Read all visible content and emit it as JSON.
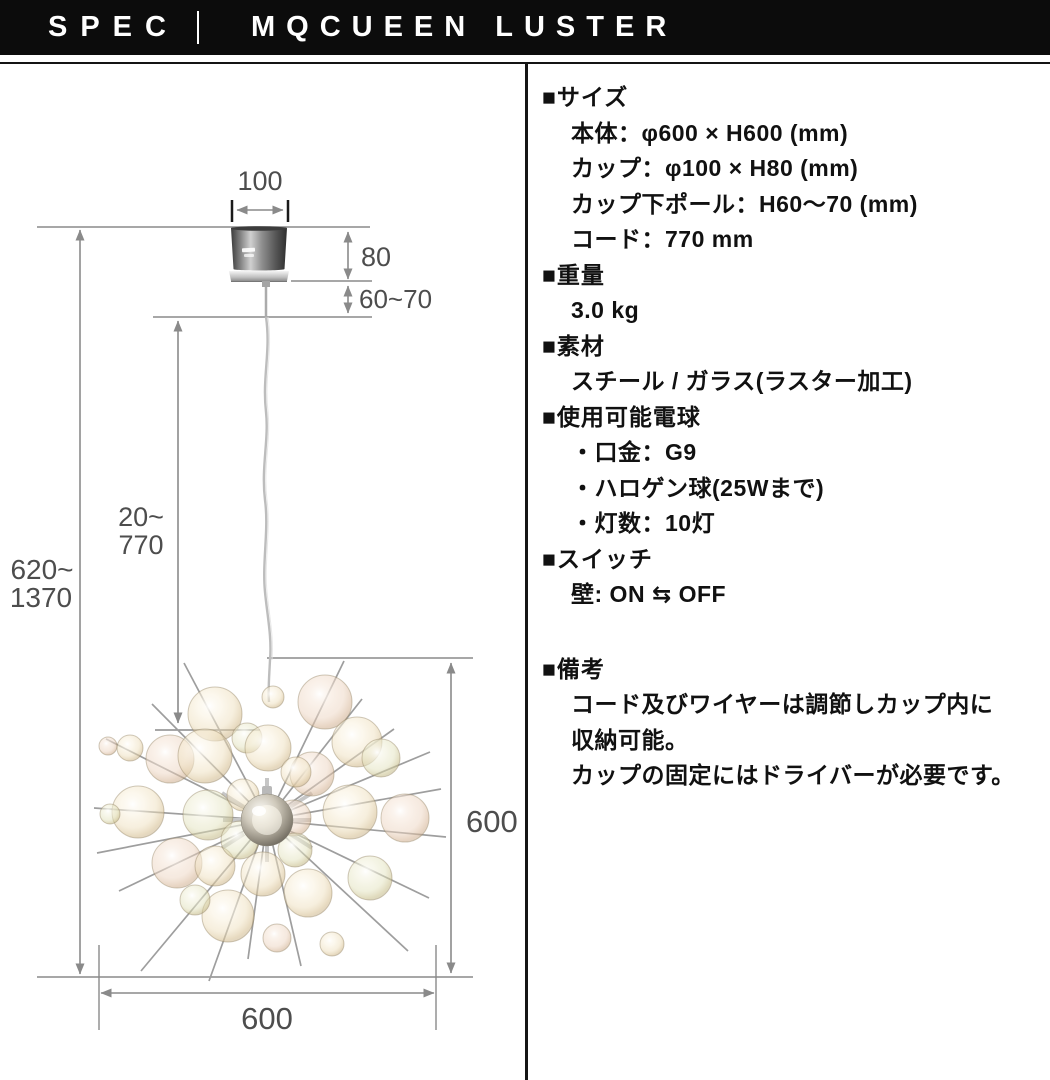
{
  "header": {
    "spec": "SPEC",
    "product": "MQCUEEN LUSTER"
  },
  "colors": {
    "header_bg": "#0c0c0c",
    "divider": "#151515",
    "diagram_line": "#8a8a8a",
    "text": "#111111",
    "glass_tint": "#ecdfc2"
  },
  "diagram": {
    "labels": {
      "canopy_width": "100",
      "canopy_height": "80",
      "pole_length": "60~70",
      "cord_range_top": "20~",
      "cord_range_bottom": "770",
      "overall_range_top": "620~",
      "overall_range_bottom": "1370",
      "body_height": "600",
      "body_width": "600"
    }
  },
  "spec": {
    "sections": [
      {
        "title": "■サイズ",
        "lines": [
          "本体：φ600 × H600 (mm)",
          "カップ：φ100 × H80 (mm)",
          "カップ下ポール：H60～70 (mm)",
          "コード：770 mm"
        ]
      },
      {
        "title": "■重量",
        "lines": [
          "3.0 kg"
        ]
      },
      {
        "title": "■素材",
        "lines": [
          "スチール / ガラス(ラスター加工)"
        ]
      },
      {
        "title": "■使用可能電球",
        "lines": [
          "・口金：G9",
          "・ハロゲン球(25Wまで)",
          "・灯数：10灯"
        ]
      },
      {
        "title": "■スイッチ",
        "lines": [
          "壁: ON ⇆ OFF"
        ]
      },
      {
        "title": "■備考",
        "lines": [
          "コード及びワイヤーは調節しカップ内に",
          "収納可能。",
          "カップの固定にはドライバーが必要です。"
        ]
      }
    ]
  }
}
